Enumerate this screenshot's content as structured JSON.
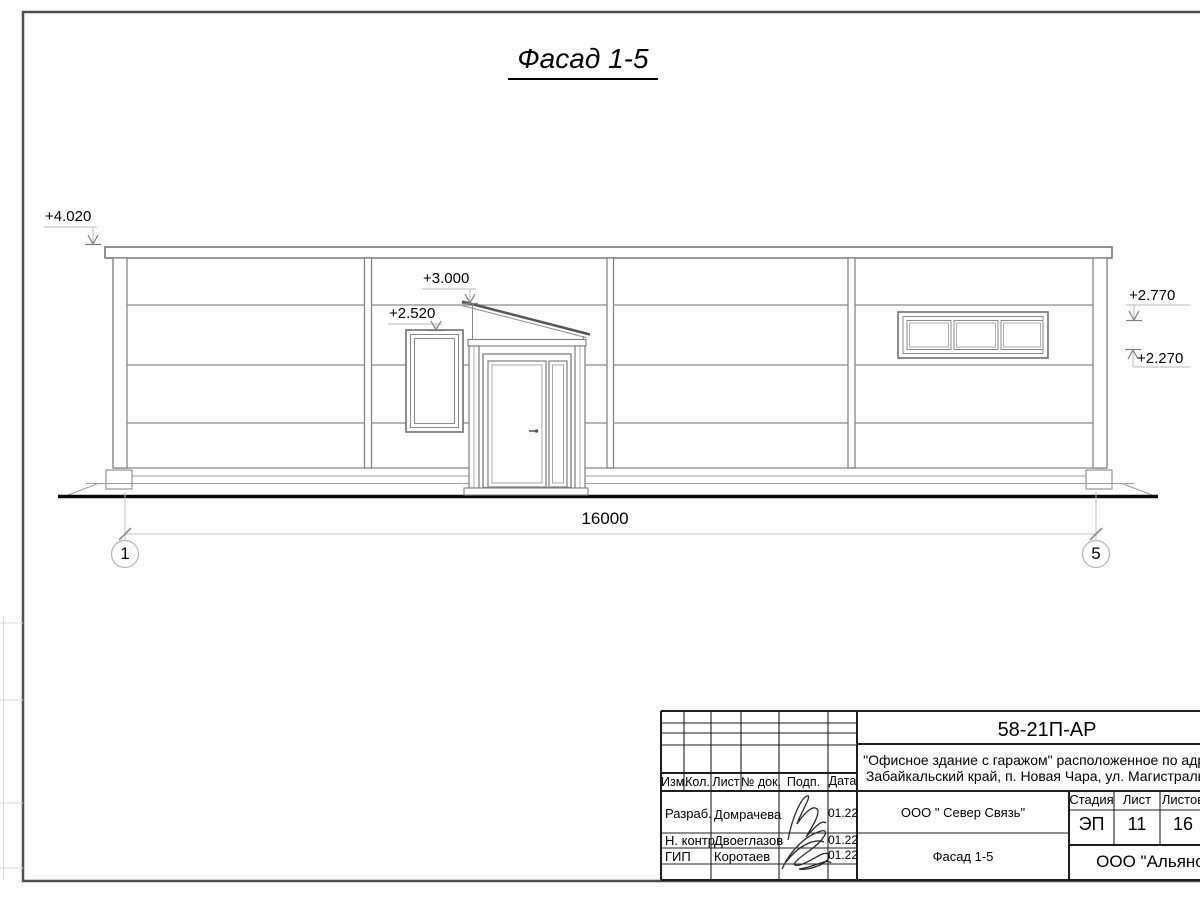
{
  "drawing": {
    "title": "Фасад 1-5",
    "dimension_total": "16000",
    "axis_left": "1",
    "axis_right": "5",
    "elevations": {
      "parapet": "+4.020",
      "canopy": "+3.000",
      "window_left": "+2.520",
      "window_right_top": "+2.770",
      "window_right_bottom": "+2.270"
    }
  },
  "title_block": {
    "doc_code": "58-21П-АР",
    "project_line1": "\"Офисное здание с гаражом\" расположенное по адресу:",
    "project_line2": "Забайкальский край, п. Новая Чара, ул. Магистральная",
    "headers": {
      "izm": "Изм.",
      "kol": "Кол.",
      "list": "Лист",
      "doc": "№ док.",
      "podp": "Подп.",
      "data": "Дата",
      "stage": "Стадия",
      "sheet": "Лист",
      "sheets": "Листов"
    },
    "rows": [
      {
        "role": "Разраб.",
        "name": "Домрачева",
        "date": "01.22"
      },
      {
        "role": "Н. контр.",
        "name": "Двоеглазов",
        "date": "01.22"
      },
      {
        "role": "ГИП",
        "name": "Коротаев",
        "date": "01.22"
      }
    ],
    "client": "ООО \" Север Связь\"",
    "sheet_title": "Фасад 1-5",
    "stage_value": "ЭП",
    "sheet_value": "11",
    "sheets_value": "16",
    "company": "ООО \"Альянс\""
  },
  "colors": {
    "line_thin": "#7d7d7d",
    "line_ground": "#0a0a0a",
    "line_border": "#4f4f4f",
    "line_titleblock": "#1f1f1f"
  }
}
